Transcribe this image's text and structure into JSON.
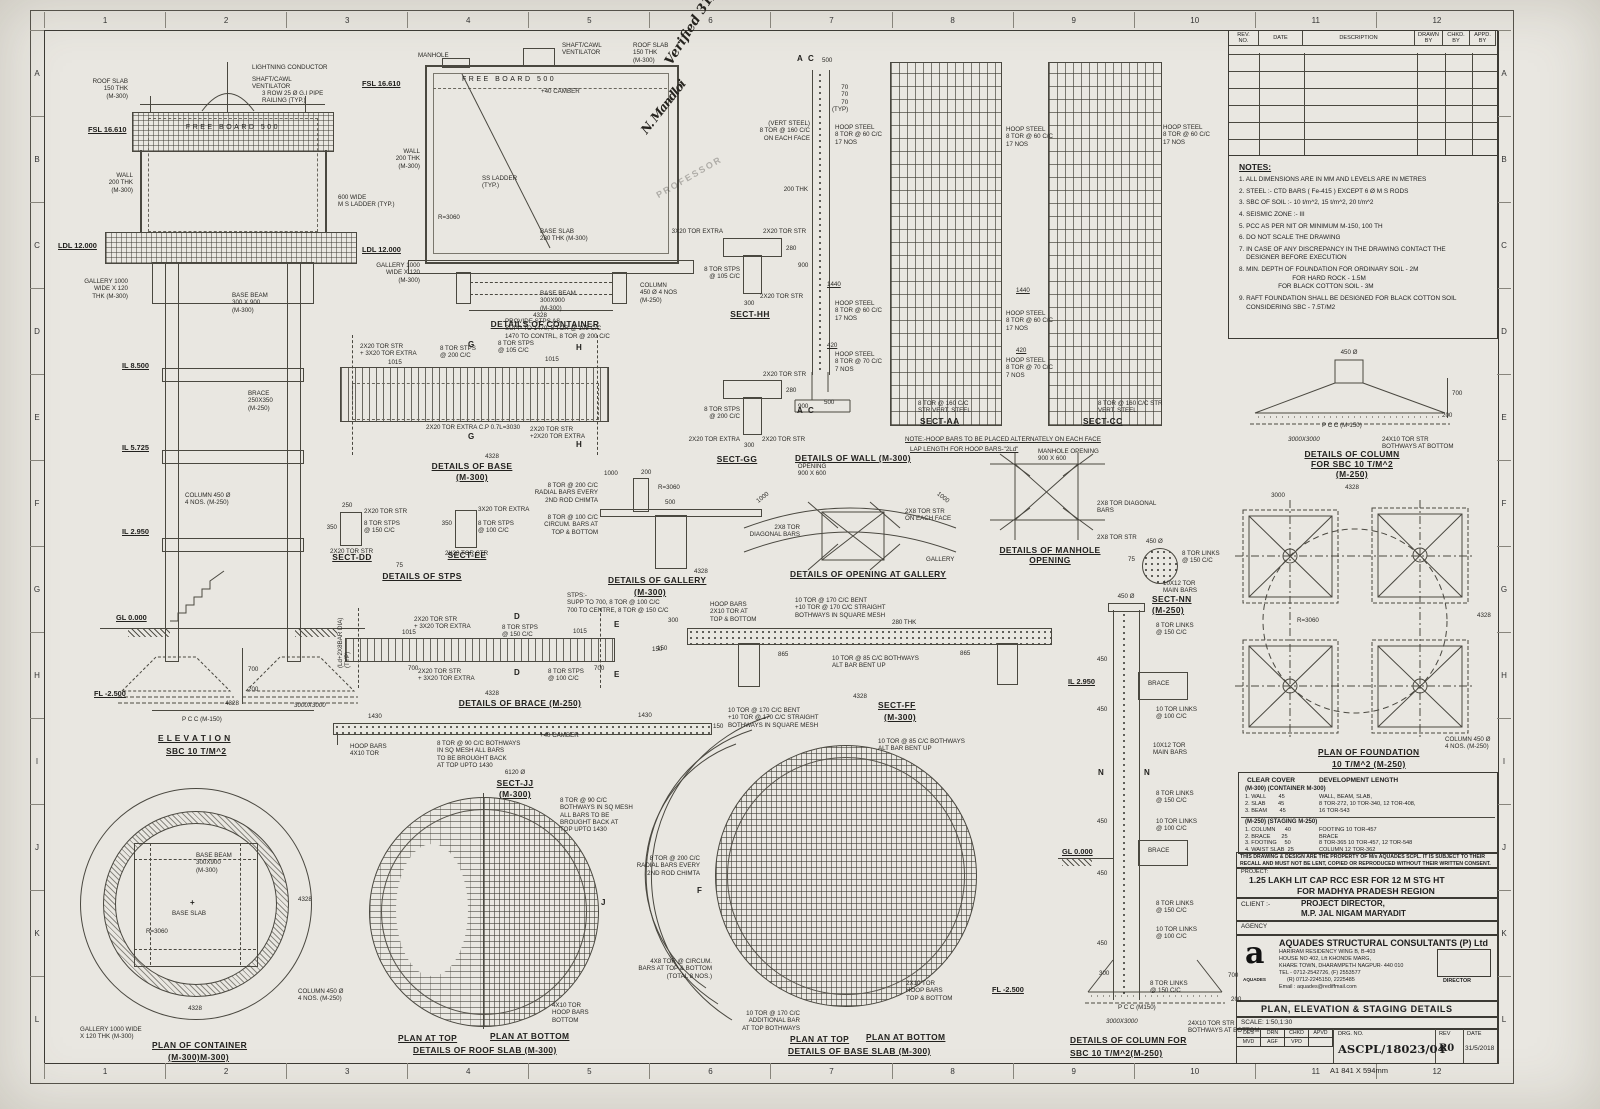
{
  "sheet": {
    "grid_cols": [
      "1",
      "2",
      "3",
      "4",
      "5",
      "6",
      "7",
      "8",
      "9",
      "10",
      "11",
      "12"
    ],
    "grid_rows": [
      "A",
      "B",
      "C",
      "D",
      "E",
      "F",
      "G",
      "H",
      "I",
      "J",
      "K",
      "L"
    ],
    "size_note": "A1   841 X 594mm"
  },
  "rev_table": {
    "headers": [
      "REV.\nNO.",
      "DATE",
      "DESCRIPTION",
      "DRAWN\nBY",
      "CHKD.\nBY",
      "APPD.\nBY"
    ]
  },
  "notes": {
    "title": "NOTES:",
    "items": [
      "1. ALL DIMENSIONS ARE IN MM AND LEVELS ARE IN METRES",
      "2. STEEL :- CTD BARS ( Fe-415 ) EXCEPT 6 Ø M S RODS",
      "3. SBC OF SOIL :- 10 t/m^2, 15 t/m^2, 20 t/m^2",
      "4. SEISMIC ZONE :- III",
      "5. PCC AS PER NIT OR MINIMUM M-150, 100 TH",
      "6. DO NOT SCALE THE DRAWING",
      "7. IN CASE OF ANY DISCREPANCY IN THE DRAWING CONTACT THE\n    DESIGNER BEFORE EXECUTION",
      "8. MIN. DEPTH OF FOUNDATION FOR ORDINARY SOIL - 2M\n                              FOR HARD ROCK - 1.5M\n                      FOR BLACK COTTON SOIL - 3M",
      "9. RAFT FOUNDATION SHALL BE DESIGNED FOR BLACK COTTON SOIL\n    CONSIDERING SBC - 7.5T/M2"
    ]
  },
  "cover_table": {
    "col1_header": "CLEAR COVER",
    "col2_header": "DEVELOPMENT LENGTH",
    "sec1_title": "(M-300) (CONTAINER M-300)",
    "sec1_rows": "1. WALL        45\n2. SLAB        45\n3. BEAM        45",
    "sec1_dev": "WALL, BEAM, SLAB,\n8 TOR-272, 10 TOR-340, 12 TOR-408,\n16 TOR-543",
    "sec2_title": "(M-250) (STAGING M-250)",
    "sec2_rows": "1. COLUMN      40\n2. BRACE       25\n3. FOOTING     50\n4. WAIST SLAB  25",
    "sec2_dev": "FOOTING 10 TOR-457\nBRACE\n8 TOR-365 10 TOR-457, 12 TOR-548\nCOLUMN 12 TOR-362"
  },
  "title_block": {
    "property_note": "THIS DRAWING & DESIGN ARE THE PROPERTY OF M/s AQUADES SCPL. IT IS SUBJECT TO THEIR RECALL AND MUST NOT BE LENT, COPIED OR REPRODUCED WITHOUT THEIR WRITTEN CONSENT.",
    "project_label": "PROJECT:",
    "project_line1": "1.25 LAKH LIT CAP RCC ESR FOR 12 M STG HT",
    "project_line2": "FOR MADHYA PRADESH REGION",
    "client_label": "CLIENT   :-",
    "client_line1": "PROJECT DIRECTOR,",
    "client_line2": "M.P. JAL NIGAM MARYADIT",
    "agency_label": "AGENCY",
    "firm_name": "AQUADES STRUCTURAL CONSULTANTS (P) Ltd",
    "firm_addr1": "HARIRAM RESIDENCY WING B, B-403",
    "firm_addr2": "HOUSE NO 402, Lft KHONDE MARG,",
    "firm_addr3": "KHARE TOWN, DHARAMPETH NAGPUR- 440 010",
    "firm_tel": "TEL - 0712-2542726, (F) 2553577",
    "firm_tel2": "(R) 0712-2245150, 2225485",
    "firm_email": "Email : aquades@rediffmail.com",
    "logo_letter": "a",
    "logo_sub": "AQUADES",
    "director_label": "DIRECTOR",
    "sheet_title": "PLAN, ELEVATION & STAGING DETAILS",
    "scale": "SCALE: 1:50,1:30",
    "sign_headers": [
      "DES",
      "DRN",
      "CHKD",
      "APVD"
    ],
    "sign_values": [
      "MVD",
      "AGF",
      "VPD",
      ""
    ],
    "drg_label": "DRG. NO.",
    "drg_no": "ASCPL/18023/04",
    "rev_label": "REV",
    "rev": "R0",
    "date_label": "DATE",
    "date": "31/5/2018"
  },
  "verification": {
    "text": "Verified\n31/5/18",
    "signature": "N. Mandloi",
    "stamp": "PROFESSOR"
  },
  "regions": {
    "elevation": {
      "title": "E L E V A T I O N",
      "subtitle": "SBC 10 T/M^2",
      "labels": [
        "LIGHTNING CONDUCTOR",
        "SHAFT/CAWL\nVENTILATOR",
        "3 ROW 25 Ø G.I PIPE\nRAILING (TYP.)",
        "ROOF SLAB\n150 THK\n(M-300)",
        "FSL 16.610",
        "FREE BOARD 500",
        "WALL\n200 THK\n(M-300)",
        "600 WIDE\nM S LADDER (TYP.)",
        "LDL 12.000",
        "GALLERY 1000\nWIDE X 120\nTHK (M-300)",
        "BASE BEAM\n300 X 900\n(M-300)",
        "IL 8.500",
        "BRACE\n250X350\n(M-250)",
        "IL 5.725",
        "COLUMN 450 Ø\n4 NOS. (M-250)",
        "IL 2.950",
        "GL 0.000",
        "FL -2.500",
        "P C C (M-150)",
        "700",
        "200",
        "4328",
        "3000X3000"
      ]
    },
    "container": {
      "title": "DETAILS OF CONTAINER",
      "labels": [
        "MANHOLE",
        "SHAFT/CAWL\nVENTILATOR",
        "ROOF SLAB\n150 THK\n(M-300)",
        "FSL 16.610",
        "FREE BOARD 500",
        "+40 CAMBER",
        "WALL\n200 THK\n(M-300)",
        "SS LADDER\n(TYP.)",
        "R=3060",
        "BASE SLAB\n280 THK (M-300)",
        "LDL 12.000",
        "GALLERY 1000\nWIDE X 120\n(M-300)",
        "BASE BEAM\n300X900\n(M-300)",
        "COLUMN\n450 Ø 4 NOS\n(M-250)",
        "4328"
      ]
    },
    "base": {
      "title": "DETAILS OF BASE",
      "subtitle": "(M-300)",
      "labels": [
        "2X20 TOR STR\n+ 3X20 TOR EXTRA",
        "8 TOR STPS\n@ 200 C/C",
        "8 TOR STPS\n@ 105 C/C",
        "1015",
        "1015",
        "2X20 TOR EXTRA C.P 0.7L=3030",
        "2X20 TOR STR\n+2X20 TOR EXTRA",
        "G",
        "G",
        "H",
        "H",
        "4328",
        "PROVIDE STPS AS-\nSUPP TO 1470, 8 TOR @ 105 C/C\n1470 TO CONTRL, 8 TOR @ 200 C/C"
      ]
    },
    "sect_hh": {
      "title": "SECT-HH",
      "labels": [
        "3X20 TOR EXTRA",
        "2X20 TOR STR",
        "8 TOR STPS\n@ 105 C/C",
        "280",
        "900",
        "300",
        "2X20 TOR STR"
      ]
    },
    "sect_gg": {
      "title": "SECT-GG",
      "labels": [
        "2X20 TOR STR",
        "8 TOR STPS\n@ 200 C/C",
        "280",
        "900",
        "300",
        "2X20 TOR EXTRA",
        "2X20 TOR STR"
      ]
    },
    "stps": {
      "title": "DETAILS OF STPS",
      "dd": "SECT-DD",
      "ee": "SECT-EE",
      "labels": [
        "250",
        "2X20 TOR STR",
        "8 TOR STPS\n@ 150 C/C",
        "350",
        "2X20 TOR STR",
        "350",
        "3X20 TOR EXTRA",
        "8 TOR STPS\n@ 100 C/C",
        "2X20 TOR STR",
        "75"
      ]
    },
    "wall": {
      "title": "DETAILS OF WALL (M-300)",
      "labels": [
        "(VERT STEEL)\n8 TOR @ 160 C/C\nON EACH FACE",
        "70\n70\n70\n(TYP)",
        "A",
        "C",
        "500",
        "200 THK",
        "HOOP STEEL\n8 TOR @ 60 C/C\n17 NOS",
        "1440",
        "HOOP STEEL\n8 TOR @ 60 C/C\n17 NOS",
        "420",
        "HOOP STEEL\n8 TOR @ 70 C/C\n7 NOS",
        "500",
        "A",
        "C"
      ]
    },
    "sect_aa": {
      "title": "SECT-AA",
      "labels": [
        "HOOP STEEL\n8 TOR @ 60 C/C\n17 NOS",
        "1440",
        "HOOP STEEL\n8 TOR @ 60 C/C\n17 NOS",
        "420",
        "HOOP STEEL\n8 TOR @ 70 C/C\n7 NOS",
        "8 TOR @ 160 C/C\nSTR VERT. STEEL"
      ]
    },
    "sect_cc": {
      "title": "SECT-CC",
      "labels": [
        "HOOP STEEL\n8 TOR @ 60 C/C\n17 NOS",
        "8 TOR @ 160 C/C STR\nVERT. STEEL"
      ]
    },
    "hoop_note": {
      "line1": "NOTE:-HOOP BARS TO BE PLACED ALTERNATELY ON EACH FACE",
      "line2": "LAP LENGTH FOR HOOP BARS-\"2Ld\""
    },
    "gallery": {
      "title": "DETAILS OF GALLERY",
      "subtitle": "(M-300)",
      "labels": [
        "1000",
        "200",
        "R=3060",
        "500",
        "8 TOR @ 200 C/C\nRADIAL BARS EVERY\n2ND ROD CHIMTA",
        "8 TOR @ 100 C/C\nCIRCUM. BARS AT\nTOP & BOTTOM",
        "4328"
      ]
    },
    "opening_gallery": {
      "title": "DETAILS OF OPENING AT GALLERY",
      "labels": [
        "OPENING\n900 X 600",
        "2X8 TOR\nDIAGONAL BARS",
        "2X8 TOR STR\nON EACH FACE",
        "GALLERY",
        "1000",
        "1000"
      ]
    },
    "manhole": {
      "title": "DETAILS OF MANHOLE\nOPENING",
      "labels": [
        "MANHOLE OPENING\n900 X 600",
        "2X8 TOR DIAGONAL\nBARS",
        "2X8 TOR STR"
      ]
    },
    "sect_nn": {
      "title": "SECT-NN",
      "subtitle": "(M-250)",
      "labels": [
        "450 Ø",
        "75",
        "8 TOR LINKS\n@ 150 C/C",
        "10X12 TOR\nMAIN BARS"
      ]
    },
    "brace": {
      "title": "DETAILS OF BRACE (M-250)",
      "labels": [
        "2X20 TOR STR\n+ 3X20 TOR EXTRA",
        "8 TOR STPS\n@ 150 C/C",
        "1015",
        "1015",
        "700",
        "700",
        "2X20 TOR STR\n+ 3X20 TOR EXTRA",
        "8 TOR STPS\n@ 100 C/C",
        "(Ld+2X8BAR DIA)\n(TYP)",
        "D",
        "D",
        "E",
        "E",
        "4328",
        "150",
        "STPS:-\nSUPP TO 700, 8 TOR @ 100 C/C\n700 TO CENTRE, 8 TOR @ 150 C/C"
      ]
    },
    "sect_jj": {
      "title": "SECT-JJ",
      "subtitle": "(M-300)",
      "labels": [
        "1430",
        "1430",
        "HOOP BARS\n4X10 TOR",
        "8 TOR @ 90 C/C BOTHWAYS\nIN SQ MESH ALL BARS\nTO BE BROUGHT BACK\nAT TOP UPTO 1430",
        "+40 CAMBER",
        "6120 Ø",
        "150"
      ]
    },
    "sect_ff": {
      "title": "SECT-FF",
      "subtitle": "(M-300)",
      "labels": [
        "HOOP BARS\n2X10 TOR AT\nTOP & BOTTOM",
        "10 TOR @ 170 C/C BENT\n+10 TOR @ 170 C/C STRAIGHT\nBOTHWAYS IN SQUARE MESH",
        "280 THK",
        "300",
        "150",
        "865",
        "865",
        "10 TOR @ 85 C/C BOTHWAYS\nALT BAR BENT UP",
        "4328"
      ]
    },
    "roof_plan": {
      "t1": "PLAN AT TOP",
      "t2": "PLAN AT BOTTOM",
      "t3": "DETAILS OF ROOF SLAB (M-300)",
      "labels": [
        "8 TOR @ 90 C/C\nBOTHWAYS IN SQ MESH\nALL BARS TO BE\nBROUGHT BACK AT\nTOP UPTO 1430",
        "4X10 TOR\nHOOP BARS\nBOTTOM",
        "J"
      ]
    },
    "base_plan": {
      "t1": "PLAN AT TOP",
      "t2": "PLAN AT BOTTOM",
      "t3": "DETAILS OF BASE SLAB (M-300)",
      "labels": [
        "10 TOR @ 170 C/C BENT\n+10 TOR @ 170 C/C STRAIGHT\nBOTHWAYS IN SQUARE MESH",
        "10 TOR @ 85 C/C BOTHWAYS\nALT BAR BENT UP",
        "8 TOR @ 200 C/C\nRADIAL BARS EVERY\n2ND ROD CHIMTA",
        "F",
        "4X8 TOR @ CIRCUM.\nBARS AT TOP & BOTTOM\n(TOTAL 8 NOS.)",
        "10 TOR @ 170 C/C\nADDITIONAL BAR\nAT TOP BOTHWAYS",
        "2X10 TOR\nHOOP BARS\nTOP & BOTTOM"
      ]
    },
    "container_plan": {
      "title": "PLAN OF CONTAINER",
      "subtitle": "(M-300)M-300)",
      "labels": [
        "BASE BEAM\n300X900\n(M-300)",
        "BASE SLAB",
        "R=3060",
        "4328",
        "4328",
        "COLUMN 450 Ø\n4 NOS. (M-250)",
        "GALLERY 1000 WIDE\nX 120 THK (M-300)"
      ]
    },
    "column_footing": {
      "title": "DETAILS OF COLUMN\nFOR SBC 10 T/M^2\n(M-250)",
      "labels": [
        "450 Ø",
        "700",
        "200",
        "P C C (M-150)",
        "3000X3000",
        "24X10 TOR STR\nBOTHWAYS AT BOTTOM",
        "4328"
      ]
    },
    "foundation_plan": {
      "title": "PLAN OF FOUNDATION",
      "subtitle": "10 T/M^2 (M-250)",
      "labels": [
        "3000",
        "4328",
        "R=3060",
        "COLUMN 450 Ø\n4 NOS. (M-250)"
      ]
    },
    "staging": {
      "title": "DETAILS OF COLUMN FOR",
      "subtitle": "SBC 10 T/M^2(M-250)",
      "labels": [
        "450 Ø",
        "8 TOR LINKS\n@ 150 C/C",
        "450",
        "IL 2.950",
        "BRACE",
        "450",
        "10 TOR LINKS\n@ 100 C/C",
        "10X12 TOR\nMAIN BARS",
        "N",
        "N",
        "8 TOR LINKS\n@ 150 C/C",
        "450",
        "10 TOR LINKS\n@ 100 C/C",
        "BRACE",
        "GL 0.000",
        "450",
        "8 TOR LINKS\n@ 150 C/C",
        "450",
        "10 TOR LINKS\n@ 100 C/C",
        "300",
        "8 TOR LINKS\n@ 150 C/C",
        "700",
        "200",
        "FL -2.500",
        "P C C (M150)",
        "3000X3000",
        "24X10 TOR STR\nBOTHWAYS AT BOTTOM"
      ]
    }
  }
}
